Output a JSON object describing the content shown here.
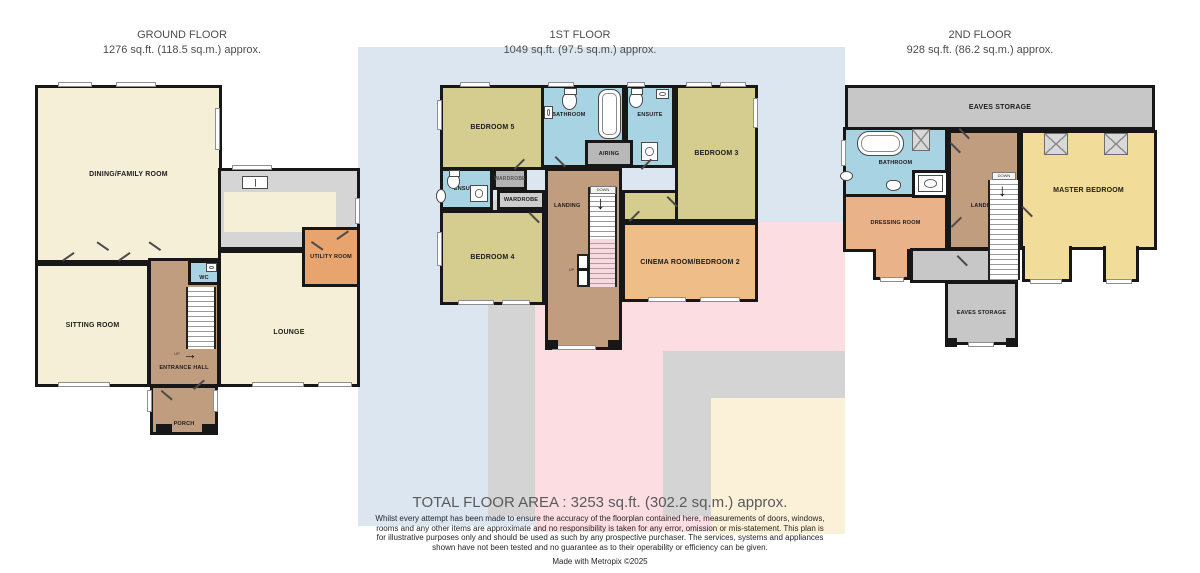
{
  "palette": {
    "wall": "#171717",
    "cream_room": "#f6efd7",
    "khaki_room": "#d5cd90",
    "cinema_orange": "#efbd88",
    "utility_orange": "#e7a46f",
    "dressing_orange": "#e9b288",
    "bath_blue": "#a8d3e2",
    "hall_tan": "#c09d7f",
    "storage_gray": "#c7c7c7",
    "master_yellow": "#f2dc99",
    "stair_pink": "#f7d9e0",
    "watermark_blue": "#dce6f1",
    "watermark_gray": "#d4d4d4",
    "watermark_pink": "#fcdde2",
    "watermark_cream": "#fbf1d8"
  },
  "floors": [
    {
      "title": "GROUND FLOOR",
      "area": "1276 sq.ft. (118.5 sq.m.) approx.",
      "rooms": {
        "dining": "DINING/FAMILY ROOM",
        "kitchen": "KITCHEN",
        "utility": "UTILITY ROOM",
        "sitting": "SITTING ROOM",
        "lounge": "LOUNGE",
        "entrance": "ENTRANCE HALL",
        "wc": "WC",
        "porch": "PORCH"
      },
      "stairs": {
        "up_label": "UP",
        "up_arrow": "→"
      }
    },
    {
      "title": "1ST FLOOR",
      "area": "1049 sq.ft. (97.5 sq.m.) approx.",
      "rooms": {
        "bedroom5": "BEDROOM 5",
        "bathroom": "BATHROOM",
        "ensuite_top": "ENSUITE",
        "bedroom3": "BEDROOM 3",
        "airing": "AIRING",
        "ensuite_left": "ENSUITE",
        "wardrobe_small": "WARDROBE",
        "wardrobe_large": "WARDROBE",
        "landing": "LANDING",
        "bedroom4": "BEDROOM 4",
        "cinema": "CINEMA ROOM/BEDROOM 2"
      },
      "stairs": {
        "down_label": "DOWN",
        "down_arrow": "↓",
        "up_label": "UP"
      }
    },
    {
      "title": "2ND FLOOR",
      "area": "928 sq.ft. (86.2 sq.m.) approx.",
      "rooms": {
        "eaves_top": "EAVES STORAGE",
        "bathroom": "BATHROOM",
        "dressing": "DRESSING ROOM",
        "landing": "LANDING",
        "master": "MASTER BEDROOM",
        "eaves_bottom": "EAVES STORAGE"
      },
      "stairs": {
        "down_label": "DOWN",
        "down_arrow": "↓"
      }
    }
  ],
  "footer": {
    "total": "TOTAL FLOOR AREA : 3253 sq.ft. (302.2 sq.m.) approx.",
    "disclaimer": "Whilst every attempt has been made to ensure the accuracy of the floorplan contained here, measurements of doors, windows, rooms and any other items are approximate and no responsibility is taken for any error, omission or mis-statement. This plan is for illustrative purposes only and should be used as such by any prospective purchaser. The services, systems and appliances shown have not been tested and no guarantee as to their operability or efficiency can be given.",
    "credit": "Made with Metropix ©2025"
  }
}
